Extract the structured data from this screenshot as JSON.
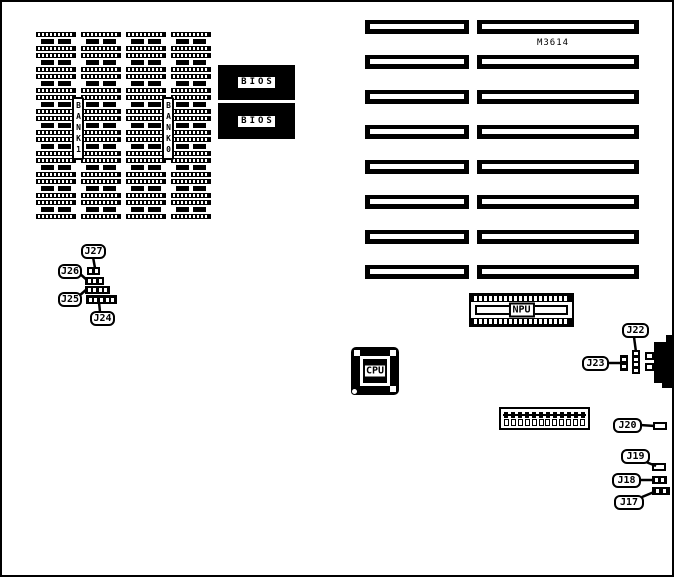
{
  "board": {
    "model": "M3614"
  },
  "chips": {
    "bank1": "BANK1",
    "bank0": "BANK0",
    "bios1": "BIOS",
    "bios2": "BIOS",
    "npu": "NPU",
    "cpu": "CPU"
  },
  "jumpers": {
    "j17": "J17",
    "j18": "J18",
    "j19": "J19",
    "j20": "J20",
    "j22": "J22",
    "j23": "J23",
    "j24": "J24",
    "j25": "J25",
    "j26": "J26",
    "j27": "J27"
  },
  "memory_grid": {
    "columns": 4,
    "rows": 9
  },
  "expansion_slots": {
    "count": 8
  },
  "dip_switch": {
    "positions": 12
  },
  "pin_blocks": {
    "j27": 2,
    "j26": 3,
    "j25": 4,
    "j24": 5,
    "j22": 4,
    "j23": 2,
    "j18": 2,
    "j17": 2
  }
}
